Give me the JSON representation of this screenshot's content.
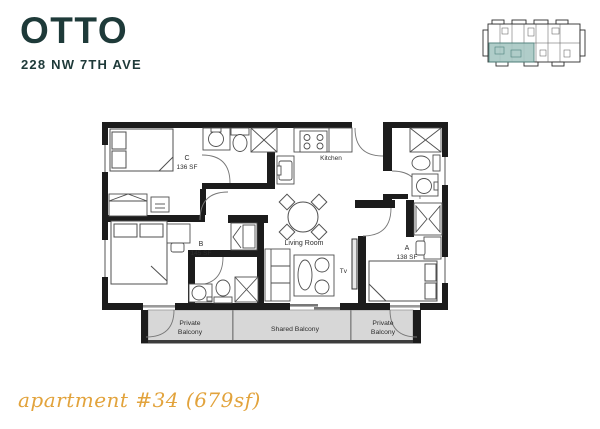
{
  "header": {
    "logo": "OTTO",
    "address": "228 NW 7TH AVE"
  },
  "key_plan": {
    "description": "building key plan with unit location highlighted"
  },
  "floor_plan": {
    "rooms": [
      {
        "name": "C",
        "area": "136 SF",
        "furniture": [
          "bed",
          "dresser",
          "nightstand"
        ]
      },
      {
        "name": "B",
        "area": "145 SF",
        "furniture": [
          "bed",
          "desk",
          "chair",
          "closet"
        ]
      },
      {
        "name": "A",
        "area": "138 SF",
        "furniture": [
          "bed",
          "desk",
          "chair",
          "closet"
        ]
      }
    ],
    "labels": {
      "kitchen": "Kitchen",
      "living_room": "Living Room",
      "tv": "Tv"
    },
    "fixtures": [
      "toilet",
      "sink",
      "shower",
      "stove",
      "kitchen-sink",
      "dining-table",
      "dining-chairs",
      "sofa",
      "coffee-table",
      "tv"
    ],
    "balconies": {
      "left": {
        "label": "Private Balcony",
        "lines": [
          "Private",
          "Balcony"
        ]
      },
      "shared": {
        "label": "Shared Balcony"
      },
      "right": {
        "label": "Private Balcony",
        "lines": [
          "Private",
          "Balcony"
        ]
      }
    }
  },
  "footer": {
    "caption": "apartment #34 (679sf)"
  },
  "colors": {
    "brand_teal": "#1e3a39",
    "accent_gold": "#e2a33c",
    "wall": "#1c1c1c",
    "balcony_fill": "#d7d7d7",
    "key_plan_highlight": "#a8c8c4"
  }
}
